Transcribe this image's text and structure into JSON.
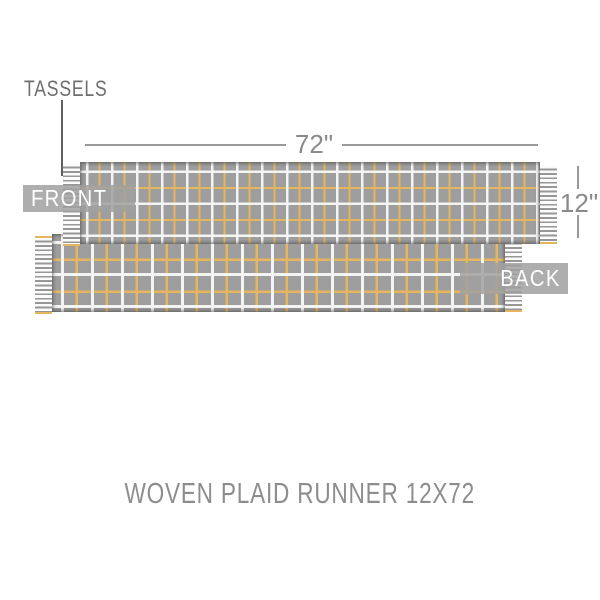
{
  "annotations": {
    "tassels_label": "TASSELS",
    "front_label": "FRONT",
    "back_label": "BACK"
  },
  "dimensions": {
    "width_label": "72\"",
    "height_label": "12\""
  },
  "caption": "WOVEN PLAID RUNNER 12X72",
  "colors": {
    "background": "#ffffff",
    "fabric_base": "#9e9e9e",
    "plaid_white": "#f4f4f4",
    "plaid_gold": "#e5b55f",
    "tassel_light": "#fbfbfb",
    "tassel_dark": "#979797",
    "label_box_bg": "rgba(160,160,160,0.85)",
    "label_text": "#ffffff",
    "annotation_text": "#6f6f6f",
    "dimension_text": "#8a8a8a",
    "dimension_line": "#999999",
    "leader_line": "#606060",
    "caption_text": "#8d8d8d"
  }
}
